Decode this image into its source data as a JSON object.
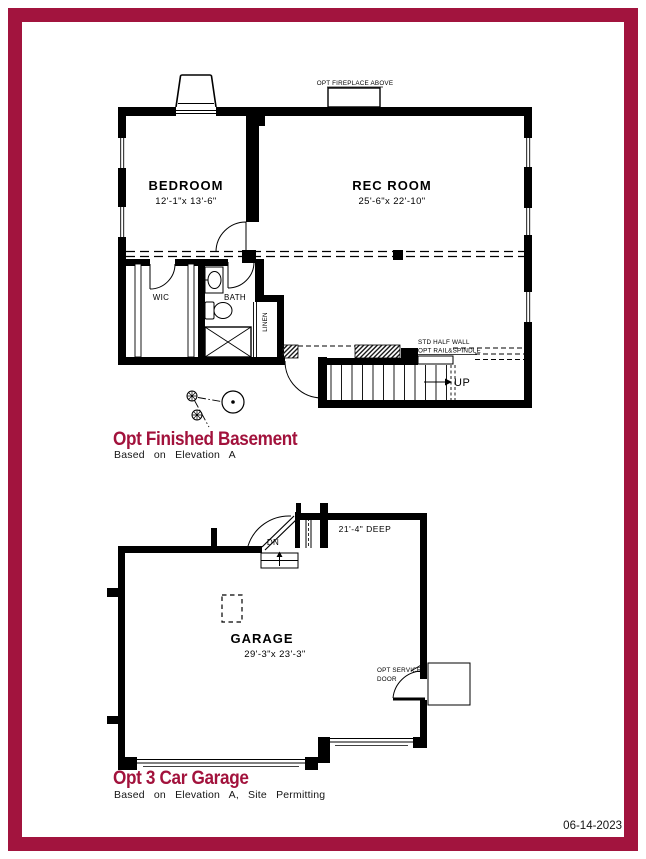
{
  "sheet": {
    "date": "06-14-2023",
    "border_color": "#A2143E",
    "title_color": "#A2123C",
    "line_color": "#000000"
  },
  "basement": {
    "title": "Opt Finished Basement",
    "subtitle": "Based on Elevation A",
    "rooms": {
      "bedroom": {
        "name": "BEDROOM",
        "dim": "12'-1\"x 13'-6\""
      },
      "rec_room": {
        "name": "REC ROOM",
        "dim": "25'-6\"x 22'-10\""
      },
      "wic": {
        "name": "WIC"
      },
      "bath": {
        "name": "BATH"
      },
      "linen": {
        "name": "LINEN"
      }
    },
    "notes": {
      "fireplace": "OPT FIREPLACE ABOVE",
      "half_wall_line1": "STD HALF WALL",
      "half_wall_line2": "OPT RAIL&SPINDLE",
      "stairs_up": "UP"
    }
  },
  "garage": {
    "title": "Opt 3 Car Garage",
    "subtitle": "Based on Elevation A, Site Permitting",
    "rooms": {
      "garage": {
        "name": "GARAGE",
        "dim": "29'-3\"x 23'-3\""
      }
    },
    "notes": {
      "depth": "21'-4\" DEEP",
      "stairs_down": "DN",
      "service_line1": "OPT SERVICE",
      "service_line2": "DOOR"
    }
  }
}
